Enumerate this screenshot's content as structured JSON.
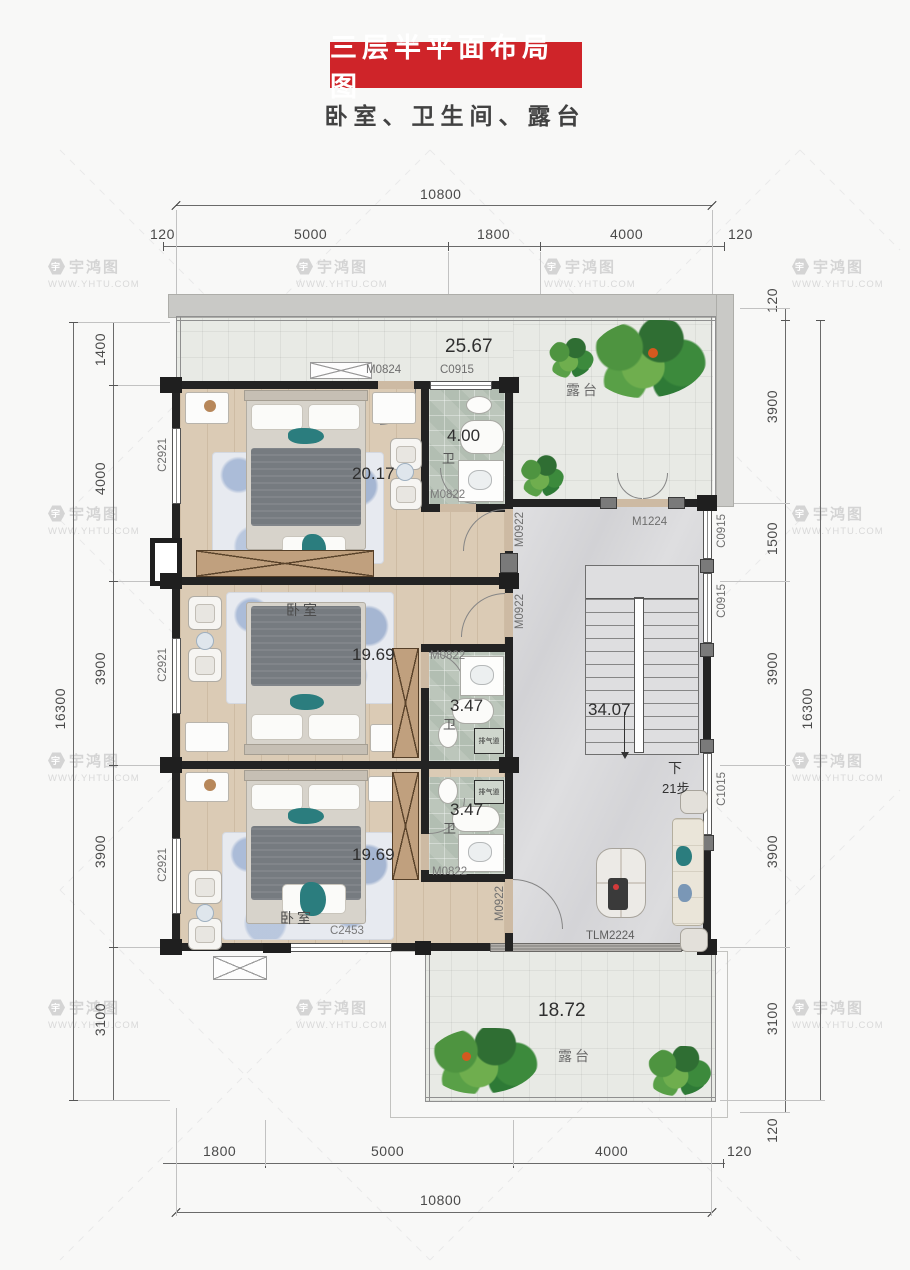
{
  "title": {
    "banner": "三层半平面布局图",
    "subtitle": "卧室、卫生间、露台"
  },
  "watermark": {
    "brand": "宇鸿图",
    "url": "WWW.YHTU.COM",
    "logo_char": "宇"
  },
  "colors": {
    "banner_red": "#cf2429",
    "wall": "#232323",
    "wood_floor": "#dbcbb5",
    "bath_tile": "#bcc6bb",
    "hall_marble": "#d8d8da",
    "terrace": "#e8eae5"
  },
  "dimensions": {
    "top": {
      "total": "10800",
      "segments": [
        "120",
        "5000",
        "1800",
        "4000",
        "120"
      ]
    },
    "bottom": {
      "total": "10800",
      "segments": [
        "1800",
        "5000",
        "4000",
        "120"
      ]
    },
    "left": {
      "total": "16300",
      "segments": [
        "1400",
        "4000",
        "3900",
        "3900",
        "3100"
      ]
    },
    "right": {
      "total": "16300",
      "segments": [
        "120",
        "3900",
        "1500",
        "3900",
        "3900",
        "3100",
        "120"
      ]
    }
  },
  "rooms": {
    "roof_terrace": {
      "area": "25.67",
      "name": "露台"
    },
    "bedroom_top": {
      "area": "20.17"
    },
    "bath_top": {
      "area": "4.00",
      "tag": "卫"
    },
    "bedroom_mid": {
      "name": "卧室",
      "area": "19.69"
    },
    "bath_mid": {
      "area": "3.47",
      "tag": "卫"
    },
    "stairs": {
      "area": "34.07",
      "down": "下",
      "steps": "21步"
    },
    "bedroom_bottom": {
      "name": "卧室",
      "area": "19.69"
    },
    "bath_bottom": {
      "area": "3.47",
      "tag": "卫"
    },
    "terrace_bottom": {
      "area": "18.72",
      "name": "露台"
    },
    "vent": "排气道"
  },
  "openings": {
    "m0824": "M0824",
    "c0915": "C0915",
    "c2921": "C2921",
    "m0822": "M0822",
    "m0922": "M0922",
    "m1224": "M1224",
    "c1015": "C1015",
    "c2453": "C2453",
    "tlm2224": "TLM2224"
  }
}
